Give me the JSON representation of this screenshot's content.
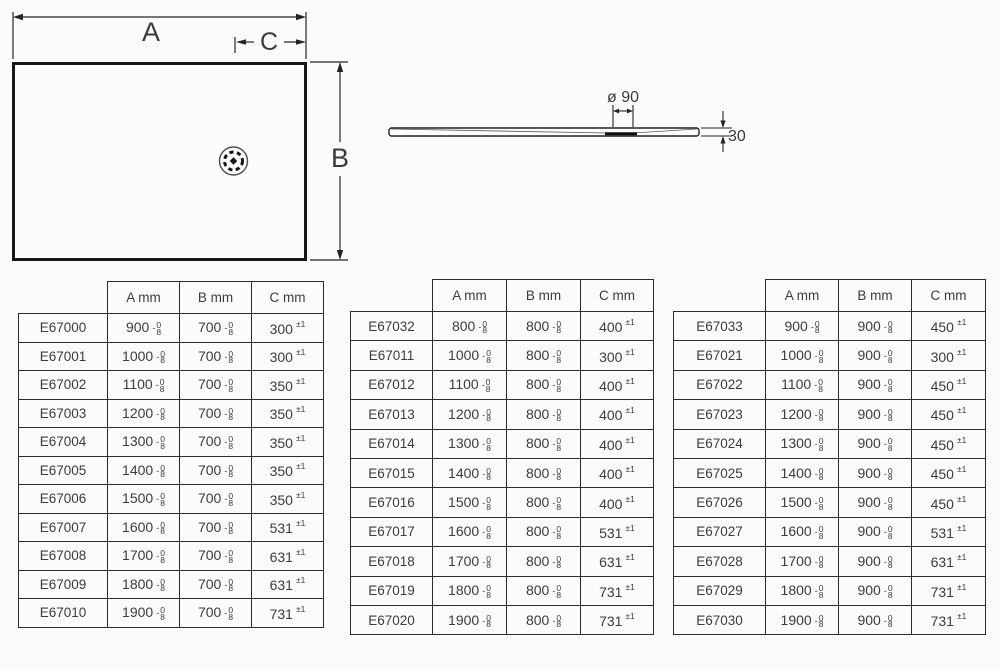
{
  "diagram": {
    "plan": {
      "width_label": "A",
      "height_label": "B",
      "drain_offset_label": "C"
    },
    "profile": {
      "drain_diameter_label": "ø 90",
      "thickness_label": "30"
    }
  },
  "tolerance": {
    "dim_sign": "-",
    "dim_upper": "0",
    "dim_lower": "8",
    "c_label": "±1"
  },
  "tables": [
    {
      "headers": {
        "code": "",
        "a": "A mm",
        "b": "B mm",
        "c": "C mm"
      },
      "rows": [
        {
          "code": "E67000",
          "a": "900",
          "b": "700",
          "c": "300"
        },
        {
          "code": "E67001",
          "a": "1000",
          "b": "700",
          "c": "300"
        },
        {
          "code": "E67002",
          "a": "1100",
          "b": "700",
          "c": "350"
        },
        {
          "code": "E67003",
          "a": "1200",
          "b": "700",
          "c": "350"
        },
        {
          "code": "E67004",
          "a": "1300",
          "b": "700",
          "c": "350"
        },
        {
          "code": "E67005",
          "a": "1400",
          "b": "700",
          "c": "350"
        },
        {
          "code": "E67006",
          "a": "1500",
          "b": "700",
          "c": "350"
        },
        {
          "code": "E67007",
          "a": "1600",
          "b": "700",
          "c": "531"
        },
        {
          "code": "E67008",
          "a": "1700",
          "b": "700",
          "c": "631"
        },
        {
          "code": "E67009",
          "a": "1800",
          "b": "700",
          "c": "631"
        },
        {
          "code": "E67010",
          "a": "1900",
          "b": "700",
          "c": "731"
        }
      ]
    },
    {
      "headers": {
        "code": "",
        "a": "A mm",
        "b": "B mm",
        "c": "C mm"
      },
      "rows": [
        {
          "code": "E67032",
          "a": "800",
          "b": "800",
          "c": "400"
        },
        {
          "code": "E67011",
          "a": "1000",
          "b": "800",
          "c": "300"
        },
        {
          "code": "E67012",
          "a": "1100",
          "b": "800",
          "c": "400"
        },
        {
          "code": "E67013",
          "a": "1200",
          "b": "800",
          "c": "400"
        },
        {
          "code": "E67014",
          "a": "1300",
          "b": "800",
          "c": "400"
        },
        {
          "code": "E67015",
          "a": "1400",
          "b": "800",
          "c": "400"
        },
        {
          "code": "E67016",
          "a": "1500",
          "b": "800",
          "c": "400"
        },
        {
          "code": "E67017",
          "a": "1600",
          "b": "800",
          "c": "531"
        },
        {
          "code": "E67018",
          "a": "1700",
          "b": "800",
          "c": "631"
        },
        {
          "code": "E67019",
          "a": "1800",
          "b": "800",
          "c": "731"
        },
        {
          "code": "E67020",
          "a": "1900",
          "b": "800",
          "c": "731"
        }
      ]
    },
    {
      "headers": {
        "code": "",
        "a": "A mm",
        "b": "B mm",
        "c": "C mm"
      },
      "rows": [
        {
          "code": "E67033",
          "a": "900",
          "b": "900",
          "c": "450"
        },
        {
          "code": "E67021",
          "a": "1000",
          "b": "900",
          "c": "300"
        },
        {
          "code": "E67022",
          "a": "1100",
          "b": "900",
          "c": "450"
        },
        {
          "code": "E67023",
          "a": "1200",
          "b": "900",
          "c": "450"
        },
        {
          "code": "E67024",
          "a": "1300",
          "b": "900",
          "c": "450"
        },
        {
          "code": "E67025",
          "a": "1400",
          "b": "900",
          "c": "450"
        },
        {
          "code": "E67026",
          "a": "1500",
          "b": "900",
          "c": "450"
        },
        {
          "code": "E67027",
          "a": "1600",
          "b": "900",
          "c": "531"
        },
        {
          "code": "E67028",
          "a": "1700",
          "b": "900",
          "c": "631"
        },
        {
          "code": "E67029",
          "a": "1800",
          "b": "900",
          "c": "731"
        },
        {
          "code": "E67030",
          "a": "1900",
          "b": "900",
          "c": "731"
        }
      ]
    }
  ]
}
